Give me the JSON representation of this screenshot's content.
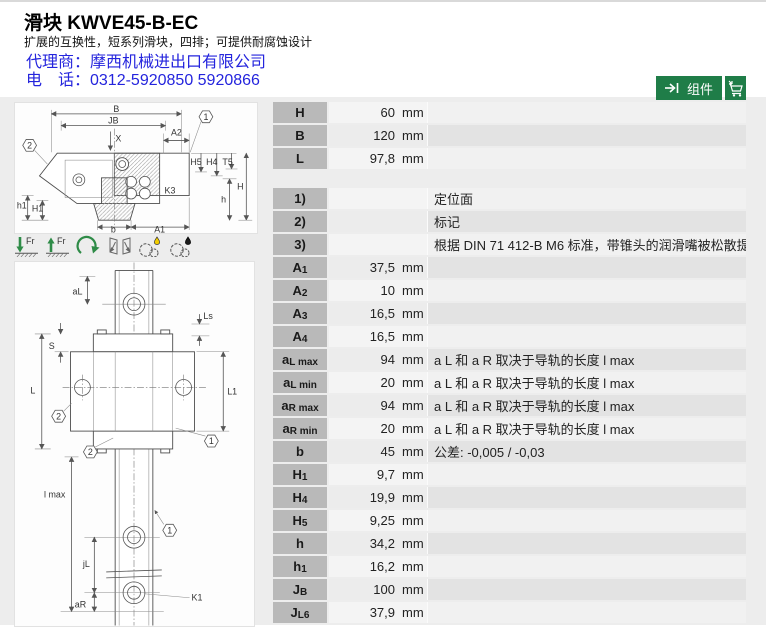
{
  "header": {
    "title": "滑块 KWVE45-B-EC",
    "subtitle": "扩展的互换性，短系列滑块，四排；可提供耐腐蚀设计",
    "dealer_line1": "代理商：摩西机械进出口有限公司",
    "dealer_line2": "电　话：0312-5920850 5920866"
  },
  "toolbar": {
    "component_button": "组件"
  },
  "colors": {
    "button_green": "#1f7d48",
    "link_blue": "#2424dd",
    "table_header_gray": "#b9b9b9",
    "drawing_green": "#2e8b47"
  },
  "icons": {
    "fr_label": "Fr"
  },
  "drawing_top": {
    "labels": {
      "B": "B",
      "JB": "JB",
      "A2": "A2",
      "X": "X",
      "H5": "H5",
      "H4": "H4",
      "T5": "T5",
      "H": "H",
      "K3": "K3",
      "h": "h",
      "h1": "h1",
      "H1": "H1",
      "b": "b",
      "A1": "A1",
      "callout1": "1",
      "callout2": "2"
    }
  },
  "drawing_bottom": {
    "labels": {
      "aL": "aL",
      "Ls": "Ls",
      "S": "S",
      "L": "L",
      "L1": "L1",
      "lmax": "l max",
      "jL": "jL",
      "aR": "aR",
      "K1": "K1",
      "callout1": "1",
      "callout2": "2"
    }
  },
  "table": {
    "sections": [
      {
        "rows": [
          {
            "label": "H",
            "sub": "",
            "value": "60",
            "unit": "mm",
            "note": ""
          },
          {
            "label": "B",
            "sub": "",
            "value": "120",
            "unit": "mm",
            "note": ""
          },
          {
            "label": "L",
            "sub": "",
            "value": "97,8",
            "unit": "mm",
            "note": ""
          }
        ]
      },
      {
        "rows": [
          {
            "label": "1)",
            "sub": "",
            "value": "",
            "unit": "",
            "note": "定位面"
          },
          {
            "label": "2)",
            "sub": "",
            "value": "",
            "unit": "",
            "note": "标记"
          },
          {
            "label": "3)",
            "sub": "",
            "value": "",
            "unit": "",
            "note": "根据 DIN 71 412-B M6 标准，带锥头的润滑嘴被松散提供"
          },
          {
            "label": "A",
            "sub": "1",
            "value": "37,5",
            "unit": "mm",
            "note": ""
          },
          {
            "label": "A",
            "sub": "2",
            "value": "10",
            "unit": "mm",
            "note": ""
          },
          {
            "label": "A",
            "sub": "3",
            "value": "16,5",
            "unit": "mm",
            "note": ""
          },
          {
            "label": "A",
            "sub": "4",
            "value": "16,5",
            "unit": "mm",
            "note": ""
          },
          {
            "label": "a",
            "sub": "L max",
            "value": "94",
            "unit": "mm",
            "note": "a L 和 a R 取决于导轨的长度 l max"
          },
          {
            "label": "a",
            "sub": "L min",
            "value": "20",
            "unit": "mm",
            "note": "a L 和 a R 取决于导轨的长度 l max"
          },
          {
            "label": "a",
            "sub": "R max",
            "value": "94",
            "unit": "mm",
            "note": "a L 和 a R 取决于导轨的长度 l max"
          },
          {
            "label": "a",
            "sub": "R min",
            "value": "20",
            "unit": "mm",
            "note": "a L 和 a R 取决于导轨的长度 l max"
          },
          {
            "label": "b",
            "sub": "",
            "value": "45",
            "unit": "mm",
            "note": "公差: -0,005 / -0,03"
          },
          {
            "label": "H",
            "sub": "1",
            "value": "9,7",
            "unit": "mm",
            "note": ""
          },
          {
            "label": "H",
            "sub": "4",
            "value": "19,9",
            "unit": "mm",
            "note": ""
          },
          {
            "label": "H",
            "sub": "5",
            "value": "9,25",
            "unit": "mm",
            "note": ""
          },
          {
            "label": "h",
            "sub": "",
            "value": "34,2",
            "unit": "mm",
            "note": ""
          },
          {
            "label": "h",
            "sub": "1",
            "value": "16,2",
            "unit": "mm",
            "note": ""
          },
          {
            "label": "J",
            "sub": "B",
            "value": "100",
            "unit": "mm",
            "note": ""
          },
          {
            "label": "J",
            "sub": "L6",
            "value": "37,9",
            "unit": "mm",
            "note": ""
          }
        ]
      }
    ]
  }
}
